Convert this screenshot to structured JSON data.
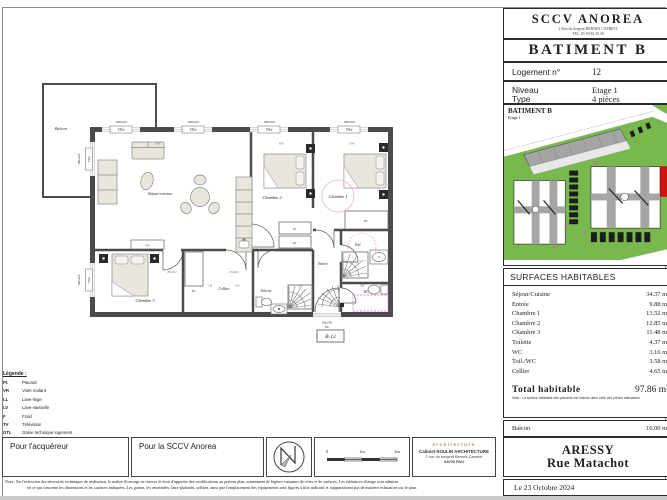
{
  "colors": {
    "wall": "#4b4b4b",
    "furn": "#e9e6df",
    "furnline": "#8a8a85",
    "dim": "#a5d8d6",
    "pink": "#f0b0dc",
    "magenta": "#e24fd0",
    "green": "#79b84d",
    "red": "#cf1212",
    "roofgray": "#a5a5a5",
    "stall": "#1c1c1c"
  },
  "title_block": {
    "company": "SCCV ANOREA",
    "company_address": "2 Rue du Sergent BERNES CAMBOT",
    "company_tel": "TEL. 05 59 84 30 30",
    "building": "BATIMENT B",
    "logement_label": "Logement n°",
    "logement_value": "12",
    "niveau_label": "Niveau",
    "niveau_value": "Etage 1",
    "type_label": "Type",
    "type_value": "4 pièces",
    "siteplan_title": "BATIMENT B",
    "siteplan_subtitle": "Etage 1",
    "surfaces_title": "SURFACES HABITABLES",
    "surfaces": [
      {
        "name": "Séjour/Cuisine",
        "area": "34.37 m²"
      },
      {
        "name": "Entrée",
        "area": "9.88 m²"
      },
      {
        "name": "Chambre 1",
        "area": "13.52 m²"
      },
      {
        "name": "Chambre 2",
        "area": "12.85 m²"
      },
      {
        "name": "Chambre 3",
        "area": "11.48 m²"
      },
      {
        "name": "Toilette",
        "area": "4.37 m²"
      },
      {
        "name": "WC",
        "area": "3.16 m²"
      },
      {
        "name": "Toil./WC",
        "area": "3.58 m²"
      },
      {
        "name": "Cellier",
        "area": "4.65 m²"
      }
    ],
    "total_label": "Total habitable",
    "total_value": "97.86 m²",
    "total_note": "Nota : La surface habitable des placards est incluse dans celle des pièces attenantes",
    "balcon_label": "Balcon",
    "balcon_value": "16.00 m²",
    "city": "ARESSY",
    "street": "Rue Matachot",
    "date": "Le 23 Octobre 2024"
  },
  "plan": {
    "balcon": "Balcon",
    "sejour": "Séjour/cuisine",
    "chambre1": "Chambre 1",
    "chambre2": "Chambre 2",
    "chambre3": "Chambre 3",
    "entree": "Entrée",
    "cellier": "Cellier",
    "toilette": "Toilette",
    "toil": "Toil.",
    "wc": "WC",
    "pl": "Pl.",
    "tv": "TV",
    "unit_ref": "B-12",
    "window_label": "180x220",
    "window_type": "VRe",
    "door_label": "90x220",
    "door_type": "PE",
    "dims": {
      "d697": "697",
      "d380": "380",
      "d304": "304",
      "d246": "246",
      "d150": "150",
      "d120": "120",
      "d208": "208",
      "door83": "83x204"
    }
  },
  "legend": {
    "title": "Légende :",
    "items": [
      {
        "abbr": "Pl.",
        "label": "Placard"
      },
      {
        "abbr": "VR",
        "label": "Volet roulant"
      },
      {
        "abbr": "LL",
        "label": "Lave-linge"
      },
      {
        "abbr": "LV",
        "label": "Lave-vaisselle"
      },
      {
        "abbr": "F",
        "label": "Froid"
      },
      {
        "abbr": "TV",
        "label": "Télévision"
      },
      {
        "abbr": "GTL",
        "label": "Gaine technique logement"
      }
    ]
  },
  "signatures": {
    "buyer": "Pour l'acquéreur",
    "seller": "Pour la SCCV Anorea"
  },
  "scale": {
    "t0": "0",
    "t1": "1m",
    "t2": "2m"
  },
  "architect": {
    "logo": "architecture",
    "line1": "Cabinet ROULIN ARCHITECTURE",
    "line2": "2 rue du sergent Bernès-Cambot",
    "line3": "64000 PAU"
  },
  "nota": {
    "line1": "Nota :   En l'exécution des nécessités techniques de réalisation, le maître d'ouvrage se réserve le droit d'apporter des modifications au présent plan, notamment de légères variantes de côtes et de surfaces. Les tolérances d'usage sont admises",
    "line2": "en ce qui concerne les dimensions et les surfaces indiquées. Les gaines, les retombées, faux-plafonds, soffites, ainsi que l'emplacement des équipements sont figurés à titre indicatif et n'apparaissent pas de manière exhaustive sur le plan."
  }
}
